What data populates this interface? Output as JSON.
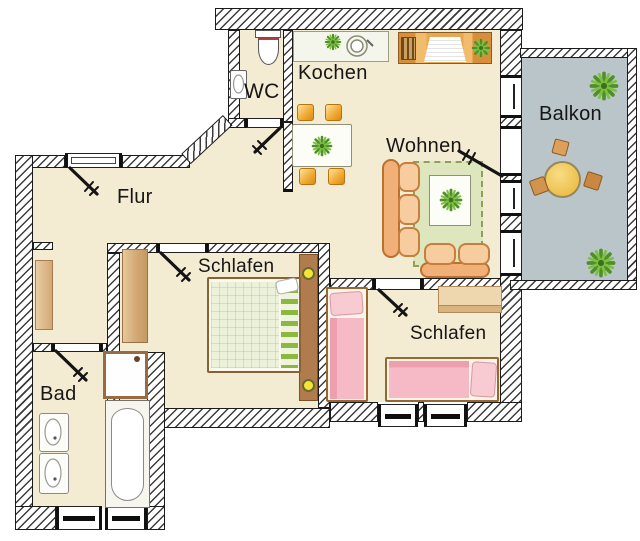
{
  "plan": {
    "rooms": {
      "flur": {
        "label": "Flur"
      },
      "wc": {
        "label": "WC"
      },
      "kochen": {
        "label": "Kochen"
      },
      "wohnen": {
        "label": "Wohnen"
      },
      "balkon": {
        "label": "Balkon"
      },
      "schlafen_left": {
        "label": "Schlafen"
      },
      "schlafen_right": {
        "label": "Schlafen"
      },
      "bad": {
        "label": "Bad"
      }
    },
    "colors": {
      "floor": "#f4ebd3",
      "balcony_floor": "#b9c5c9",
      "rug_green": "#dde6bd",
      "sofa_orange": "#f0b078",
      "chair_orange": "#f0a830",
      "bed_green": "#ebf2d9",
      "bed_pink": "#f2aebc",
      "wood_brown": "#b07c4e",
      "lamp_yellow": "#f4e339",
      "plant_green": "#5f9b2f",
      "balcony_table_yellow": "#eec04e",
      "wall_hatch_line": "#3c3c3c"
    },
    "furniture": {
      "wc": [
        "toilet-icon",
        "hand-basin-icon"
      ],
      "kochen": [
        "kitchen-counter-sink-icon",
        "dining-table-icon",
        "chair-icon",
        "plant-icon"
      ],
      "wohnen": [
        "corner-sofa-icon",
        "coffee-table-plant-icon",
        "rug-icon",
        "tv-sideboard-icon"
      ],
      "balkon": [
        "round-table-icon",
        "stool-icon",
        "plant-icon"
      ],
      "schlafen_left": [
        "double-bed-icon",
        "wardrobe-icon",
        "bedside-lamp-icon"
      ],
      "schlafen_right": [
        "single-bed-icon",
        "single-bed-icon",
        "sideboard-icon"
      ],
      "bad": [
        "bathtub-icon",
        "shower-icon",
        "wash-basin-icon"
      ],
      "flur": [
        "cabinet-icon"
      ]
    }
  }
}
